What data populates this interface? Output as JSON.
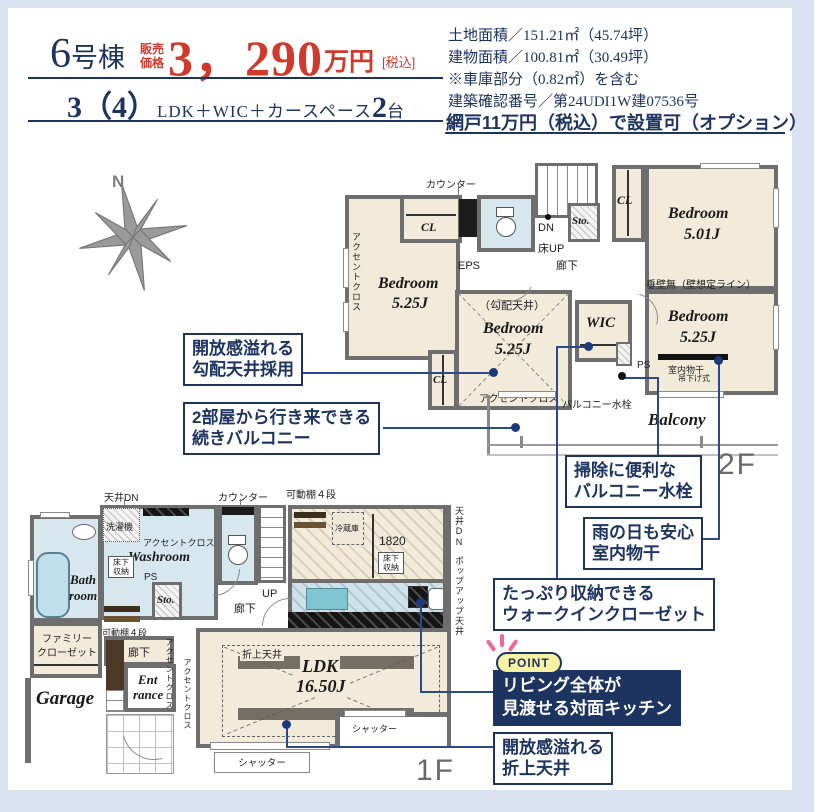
{
  "colors": {
    "navy": "#1d3461",
    "price_red": "#cf3a2c",
    "wall_gray": "#6e6e6e",
    "floor_cream": "#f2ebd9",
    "water_blue": "#d6e8ee",
    "frame_blue": "#dbe2f2",
    "point_yellow": "#f6f1a3",
    "accent_pink": "#f0679a",
    "connector": "#2b4a8b"
  },
  "header": {
    "unit_num": "6",
    "unit_suffix": "号棟",
    "price_label_1": "販売",
    "price_label_2": "価格",
    "price_value": "3，290",
    "price_unit": "万円",
    "price_tax": "[税込]",
    "layout_count": "3（4）",
    "layout_text": "LDK＋WIC＋カースペース",
    "cars_num": "2",
    "cars_unit": "台"
  },
  "info": {
    "land": "土地面積／151.21㎡（45.74坪）",
    "building": "建物面積／100.81㎡（30.49坪）",
    "garage_note": "※車庫部分（0.82㎡）を含む",
    "confirmation": "建築確認番号／第24UDI1W建07536号",
    "option": "網戸11万円（税込）で設置可（オプション）"
  },
  "compass": {
    "north": "N"
  },
  "f2": {
    "floor_label": "2F",
    "counter": "カウンター",
    "cl_top": "CL",
    "eps": "EPS",
    "accent_left": "アクセントクロス",
    "bed_left_name": "Bedroom",
    "bed_left_size": "5.25J",
    "dn": "DN",
    "floor_up": "床UP",
    "hall": "廊下",
    "sto": "Sto.",
    "cl_right": "CL",
    "bed_tr_name": "Bedroom",
    "bed_tr_size": "5.01J",
    "no_wall": "垂壁無（壁想定ライン）",
    "slope": "（勾配天井）",
    "bed_c_name": "Bedroom",
    "bed_c_size": "5.25J",
    "accent_c": "アクセントクロス",
    "cl_bottom": "CL",
    "wic": "WIC",
    "ps": "PS",
    "faucet": "バルコニー水栓",
    "bed_r_name": "Bedroom",
    "bed_r_size": "5.25J",
    "drying": "室内物干",
    "drying_sub": "吊下げ式",
    "balcony": "Balcony"
  },
  "f1": {
    "floor_label": "1F",
    "ceiling_dn": "天井DN",
    "counter": "カウンター",
    "shelf_top": "可動棚４段",
    "washer": "洗濯機",
    "accent_wash": "アクセントクロス",
    "washroom": "Washroom",
    "underfloor1": "床下収納",
    "ps": "PS",
    "bath1": "Bath",
    "bath2": "room",
    "sto": "Sto.",
    "up": "UP",
    "hall_stairs": "廊下",
    "fam1": "ファミリー",
    "fam2": "クローゼット",
    "garage": "Garage",
    "shelf_bath": "可動棚４段",
    "hall_ent": "廊下",
    "ent1": "Ent",
    "ent2": "rance",
    "accent_e1": "アクセントクロス",
    "accent_e2": "アクセントクロス",
    "fridge": "冷蔵庫",
    "dim": "1820",
    "underfloor2": "床下収納",
    "ceiling_dn_r": "天井DN",
    "popup": "ポップアップ天井",
    "accent_k": "アクセントクロス",
    "oriage": "折上天井",
    "ldk": "LDK",
    "ldk_size": "16.50J",
    "shutter1": "シャッター",
    "shutter2": "シャッター"
  },
  "callouts": {
    "slope": {
      "line1": "開放感溢れる",
      "line2": "勾配天井採用"
    },
    "balcony": {
      "line1": "2部屋から行き来できる",
      "line2": "続きバルコニー"
    },
    "faucet": {
      "line1": "掃除に便利な",
      "line2": "バルコニー水栓"
    },
    "drying": {
      "line1": "雨の日も安心",
      "line2": "室内物干"
    },
    "wic": {
      "line1": "たっぷり収納できる",
      "line2": "ウォークインクローゼット"
    },
    "oriage": {
      "line1": "開放感溢れる",
      "line2": "折上天井"
    }
  },
  "point": {
    "badge": "POINT",
    "line1": "リビング全体が",
    "line2": "見渡せる対面キッチン"
  }
}
